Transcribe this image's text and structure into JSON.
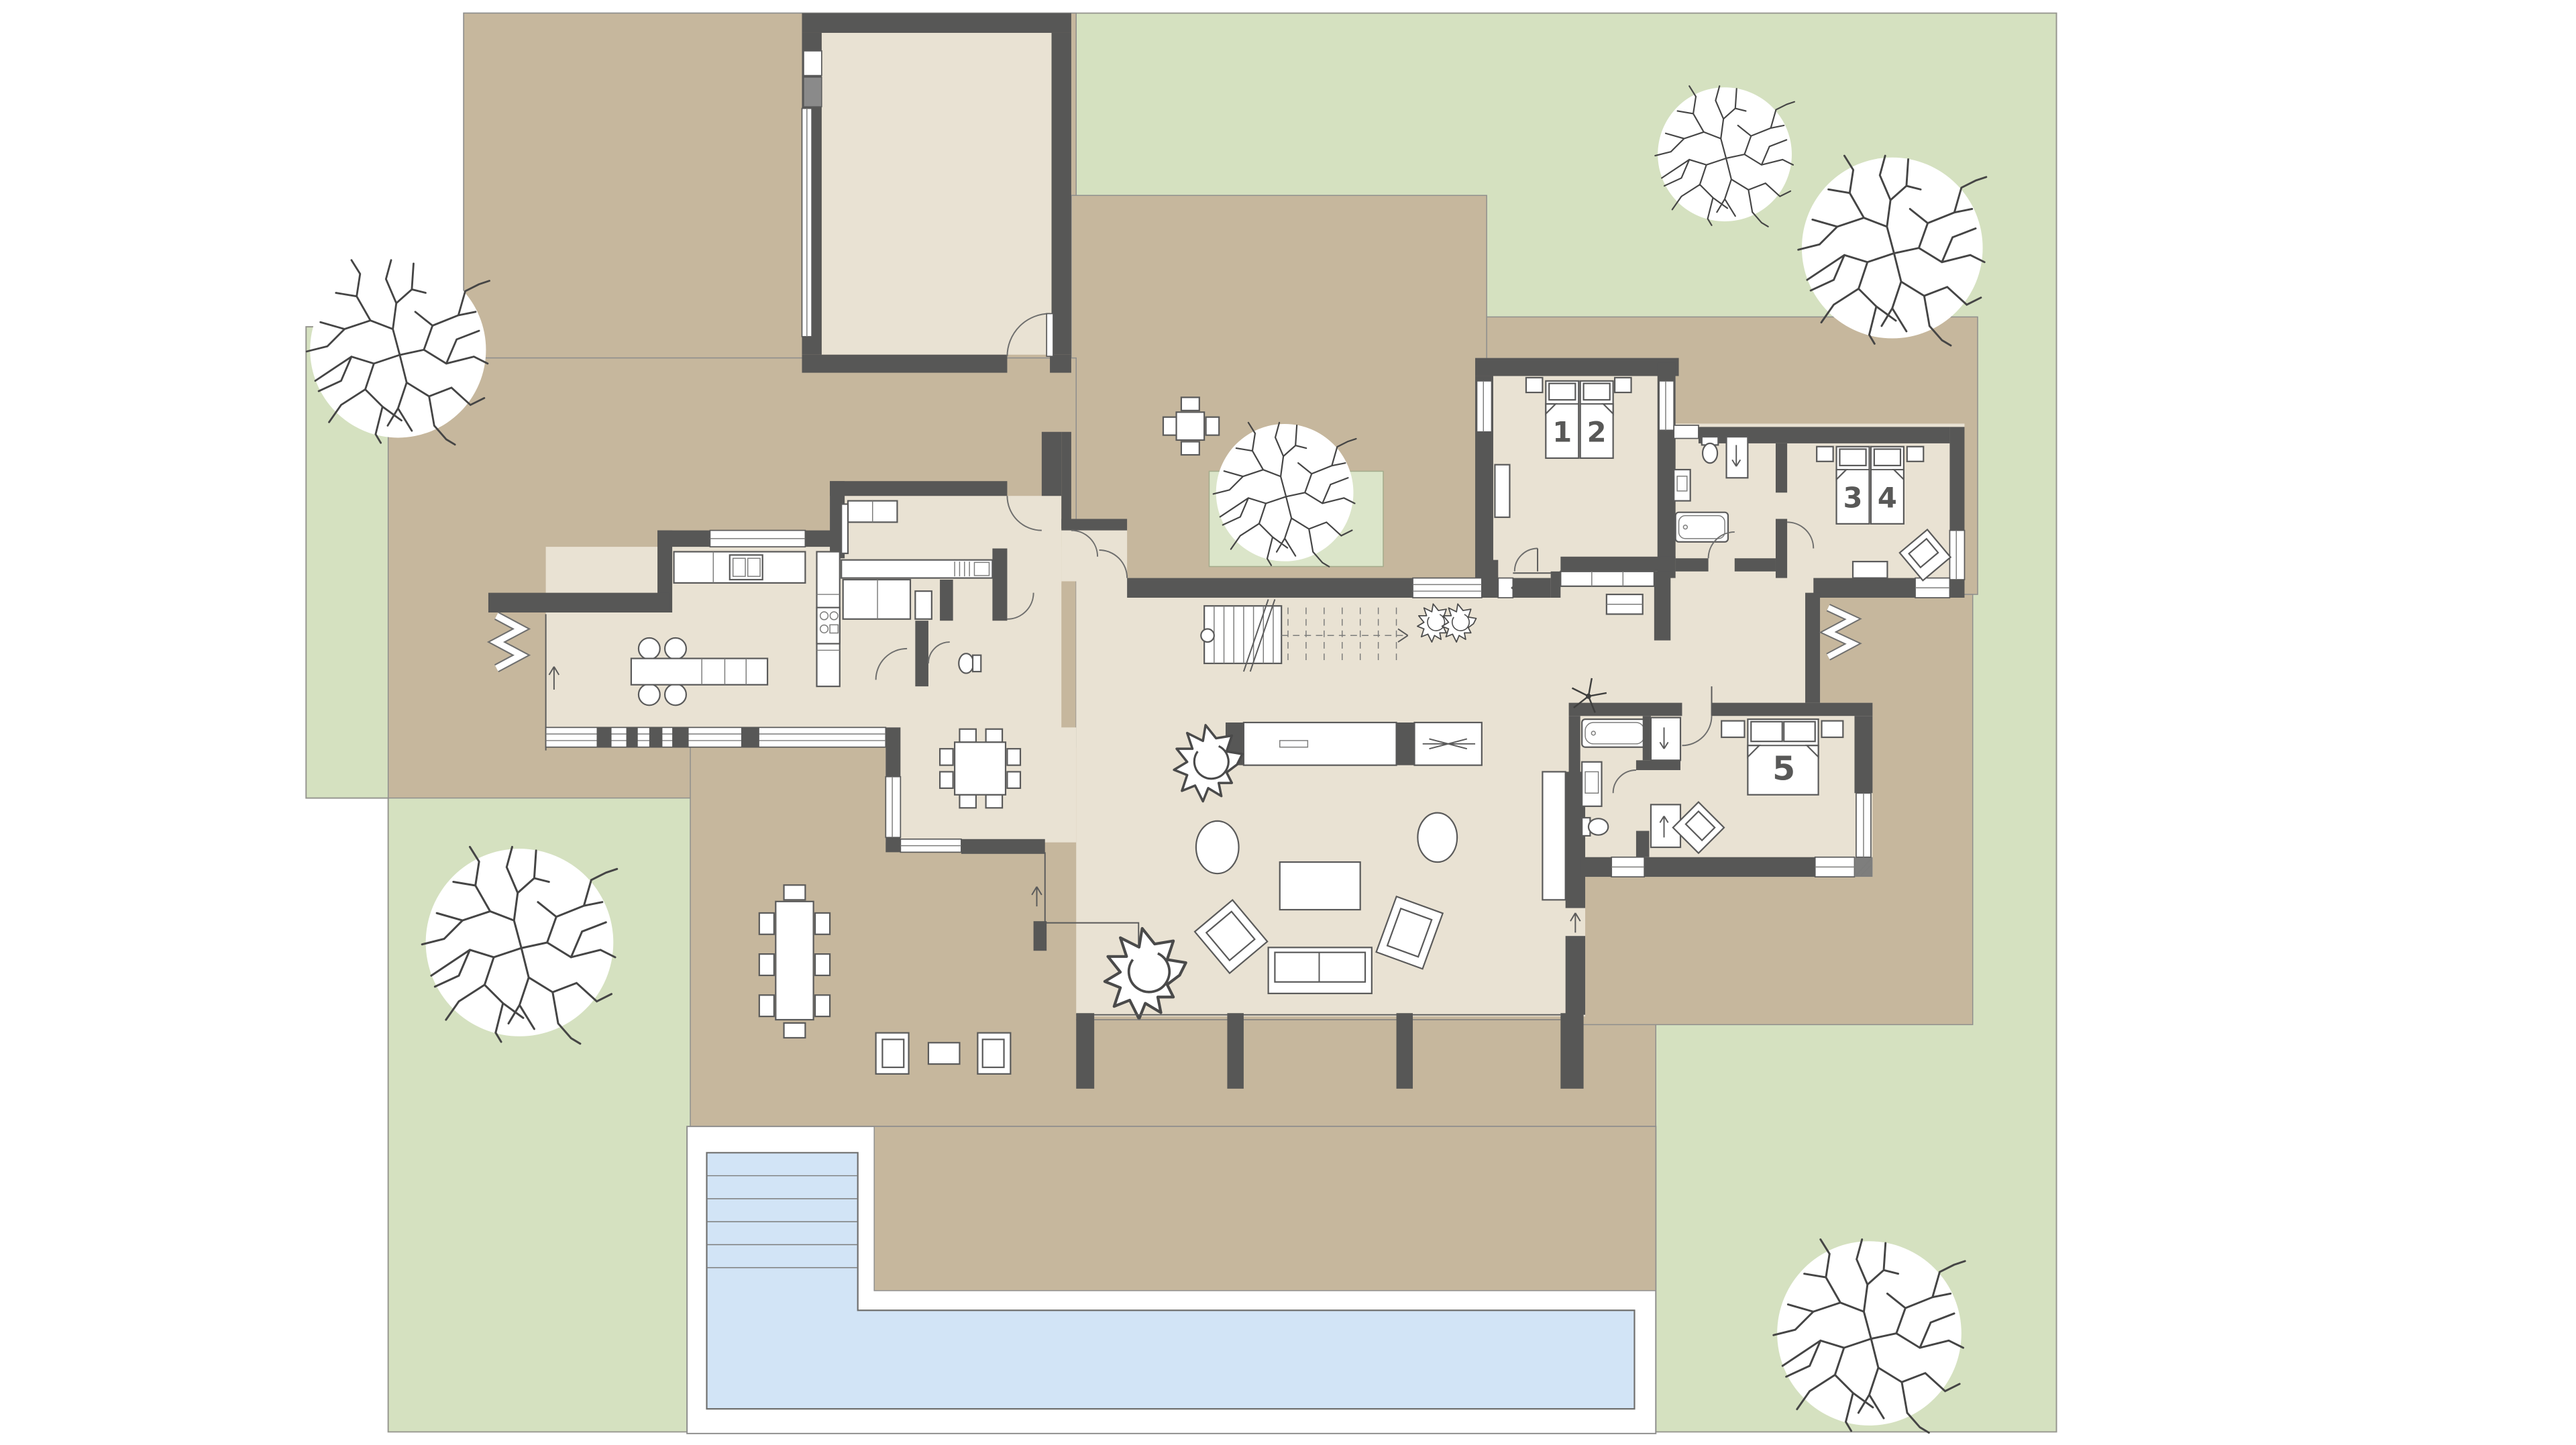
{
  "plan": {
    "type": "architectural-floor-plan-with-garden",
    "bed_labels": [
      {
        "room": "bedroom-1-2",
        "label": "1"
      },
      {
        "room": "bedroom-1-2",
        "label": "2"
      },
      {
        "room": "bedroom-3-4",
        "label": "3"
      },
      {
        "room": "bedroom-3-4",
        "label": "4"
      },
      {
        "room": "bedroom-5",
        "label": "5"
      }
    ],
    "areas": {
      "garden": "lawn",
      "terrace": "paved terrace",
      "pool": "swimming pool with steps",
      "garage": "garage",
      "courtyard": "atrium courtyard with tree",
      "kitchen": "kitchen with island",
      "dining": "dining room",
      "living": "living room",
      "hall": "entrance hall with stairs",
      "bedroom-1-2": "twin bedroom",
      "bedroom-3-4": "twin bedroom",
      "bedroom-5": "master bedroom with bathroom"
    },
    "colors": {
      "lawn": "#d5e1c0",
      "planting_bed": "#dbe5c9",
      "terrace": "#c6b79d",
      "interior_floor": "#e9e2d3",
      "walls": "#575756",
      "pool_water": "#d2e4f6",
      "pool_deck": "#ffffff",
      "furniture_outline": "#5a5a5a",
      "room_number": "#585857"
    }
  }
}
